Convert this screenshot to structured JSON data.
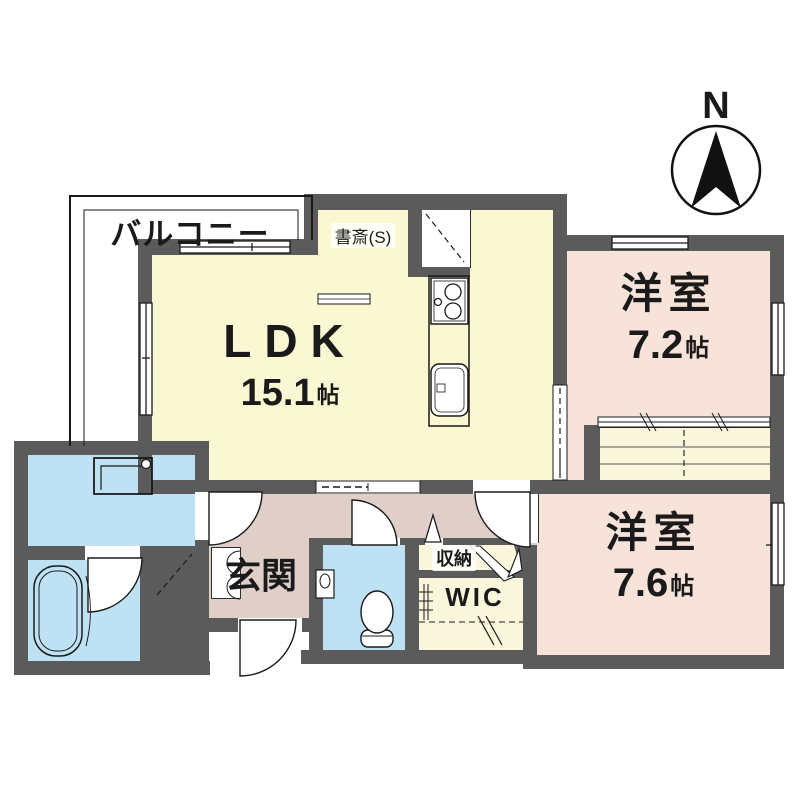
{
  "plan": {
    "balcony_label": "バルコニー",
    "compass_label": "N",
    "rooms": {
      "ldk": {
        "name": "LDK",
        "area": "15.1",
        "unit": "帖"
      },
      "study": {
        "name": "書斎(S)"
      },
      "western1": {
        "name": "洋室",
        "area": "7.2",
        "unit": "帖"
      },
      "western2": {
        "name": "洋室",
        "area": "7.6",
        "unit": "帖"
      },
      "entrance": {
        "name": "玄関"
      },
      "storage": {
        "name": "収納"
      },
      "wic": {
        "name": "WIC"
      }
    },
    "colors": {
      "wall": "#5B5B5B",
      "room_yellow": "#FAF8D2",
      "room_pink": "#F8E3DA",
      "hall_mauve": "#E0CEC9",
      "water_blue": "#BEE2F3",
      "outline": "#1a1a1a"
    }
  }
}
